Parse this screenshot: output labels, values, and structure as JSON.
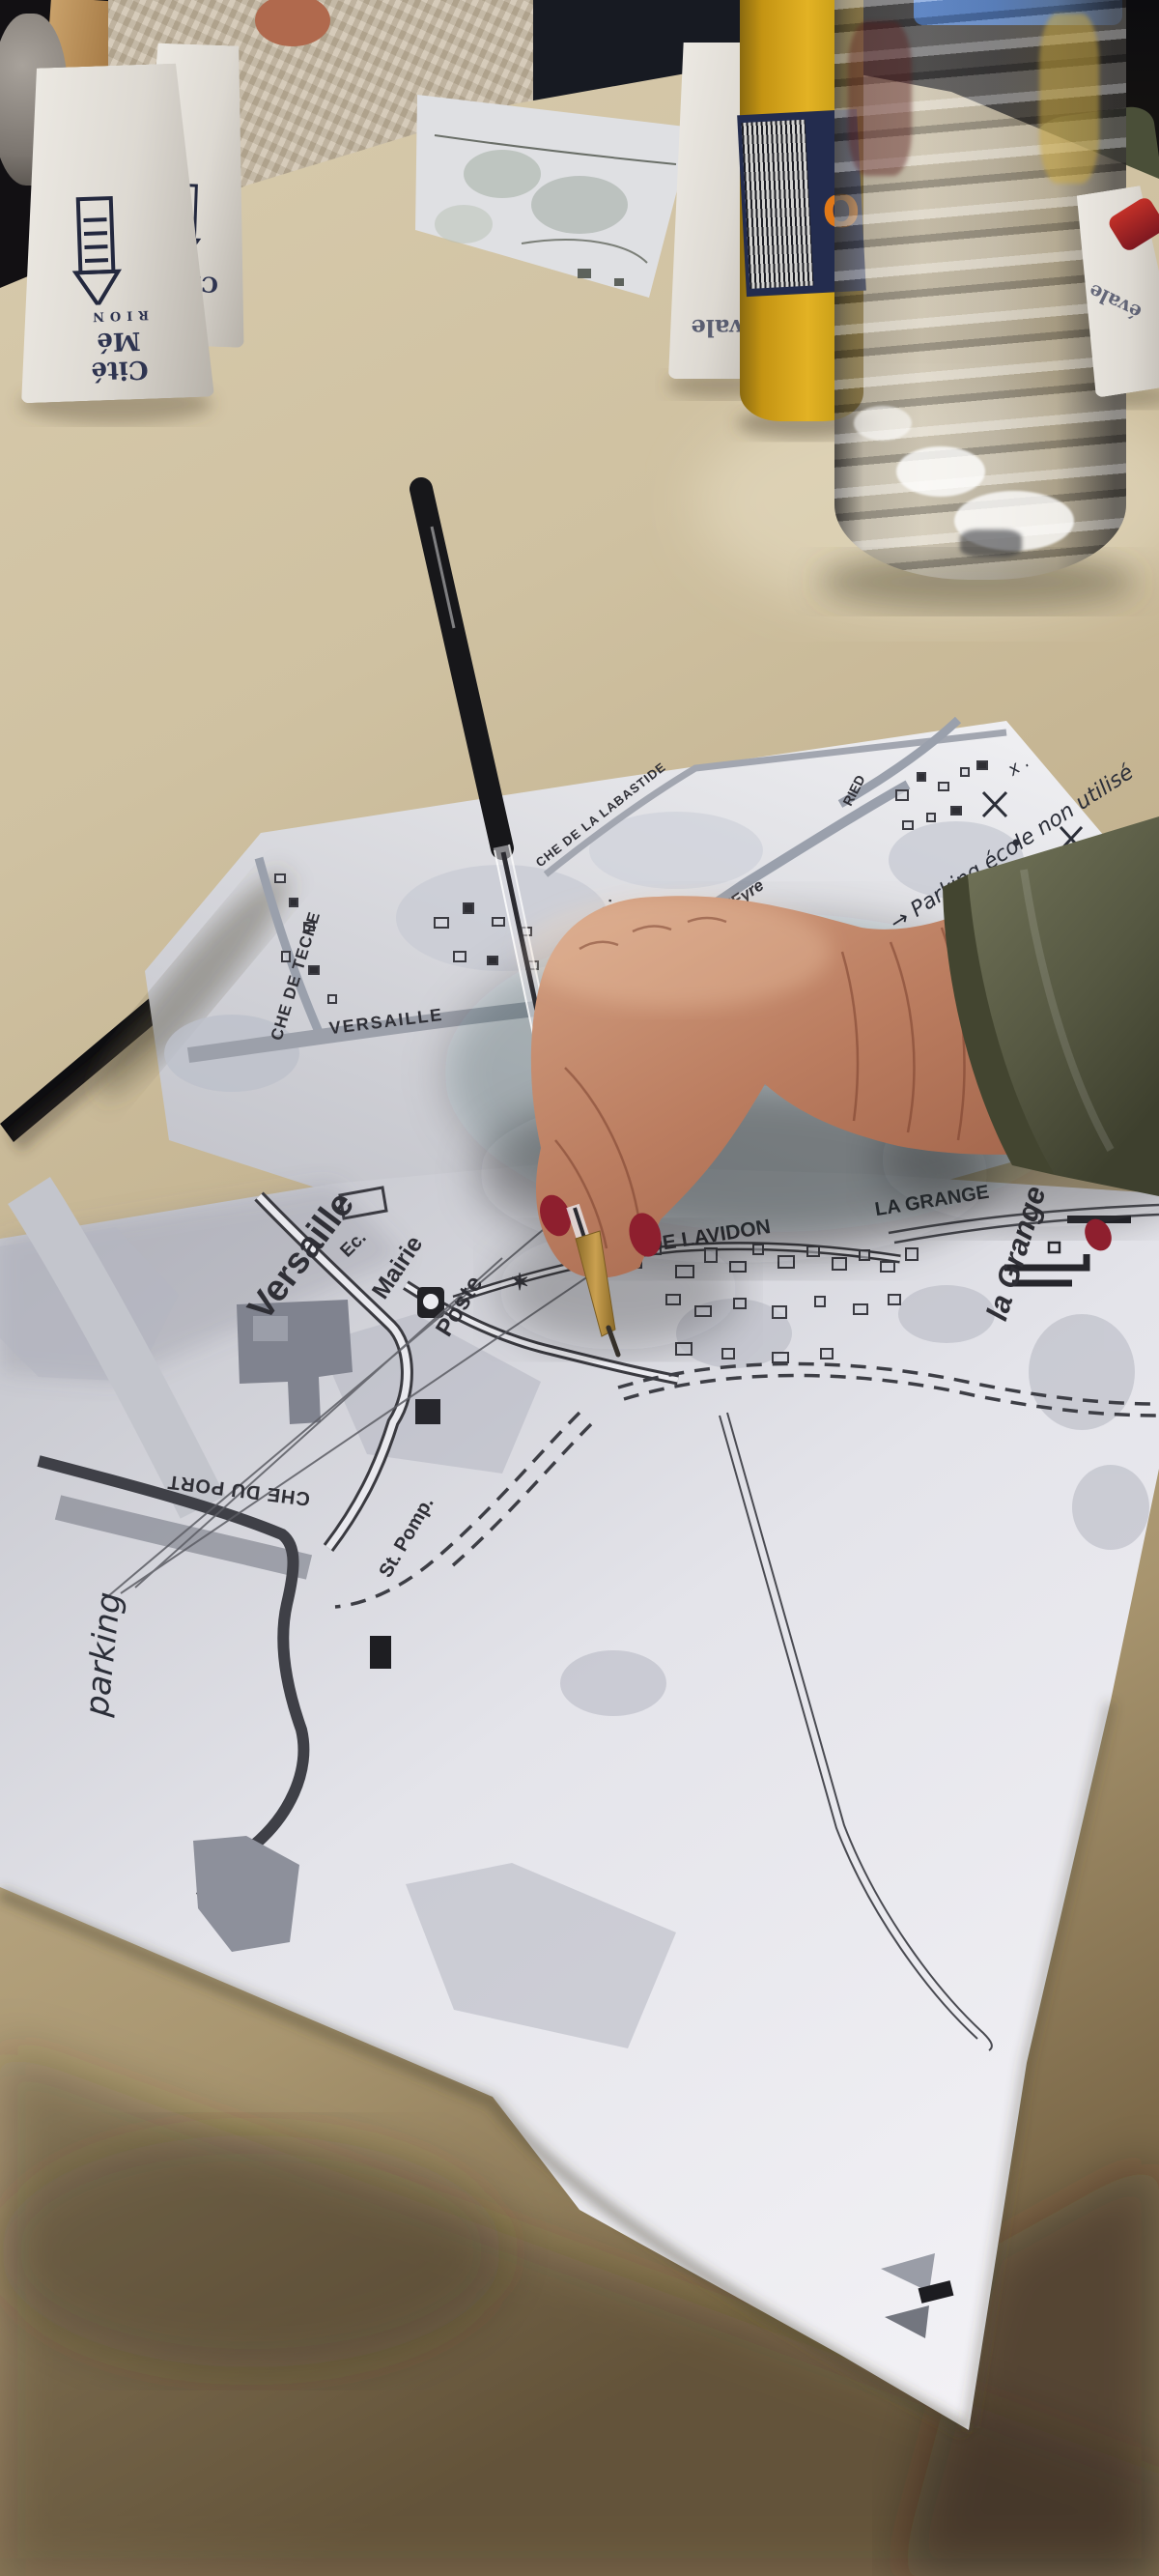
{
  "colors": {
    "table": "#cfc1a1",
    "paper": "#ececf1",
    "map_ink": "#2f2f36",
    "handwriting_ink": "#2b2e38",
    "skin": "#b97a5f",
    "sleeve_olive": "#5c5e46",
    "nail_red": "#8e1f2e",
    "orange_drink": "#d8a71c",
    "label_navy": "#232c4e",
    "lighter_red": "#b3252b",
    "strap_black": "#0d0d10"
  },
  "cups": {
    "left_front": {
      "brand_line": "Cité Mé",
      "brand_mark": "RION"
    },
    "left_back": {
      "brand_line": "Cité"
    },
    "middle": {
      "brand_line": "évale"
    },
    "right": {
      "brand_line": "évale"
    }
  },
  "orange_bottle": {
    "label_letter": "O"
  },
  "upper_map": {
    "labels": {
      "teche": "CHE DE TECHE",
      "versaille": "VERSAILLE",
      "labastide": "CHE DE LA LABASTIDE",
      "de": "de .",
      "eyre": "l'Eyre",
      "ried": "RIED"
    },
    "handwriting": [
      "x .",
      "→ Parking école non utilisé",
      "Délimiter les places",
      "de en compte les besoins de",
      "s âgés ou dans le besoin",
      "30 mn)",
      "ter les pl"
    ]
  },
  "lower_map": {
    "labels": {
      "versaille": "Versaille",
      "ecole": "Ec.",
      "mairie": "Mairie",
      "poste": "Poste",
      "lavidon": "R DE LAVIDON",
      "la_grange_caps": "LA GRANGE",
      "la_grange": "la Grange",
      "che_du_port": "CHE DU PORT",
      "st_pomp": "St. Pomp.",
      "star": "✶"
    },
    "handwriting": "parking"
  }
}
